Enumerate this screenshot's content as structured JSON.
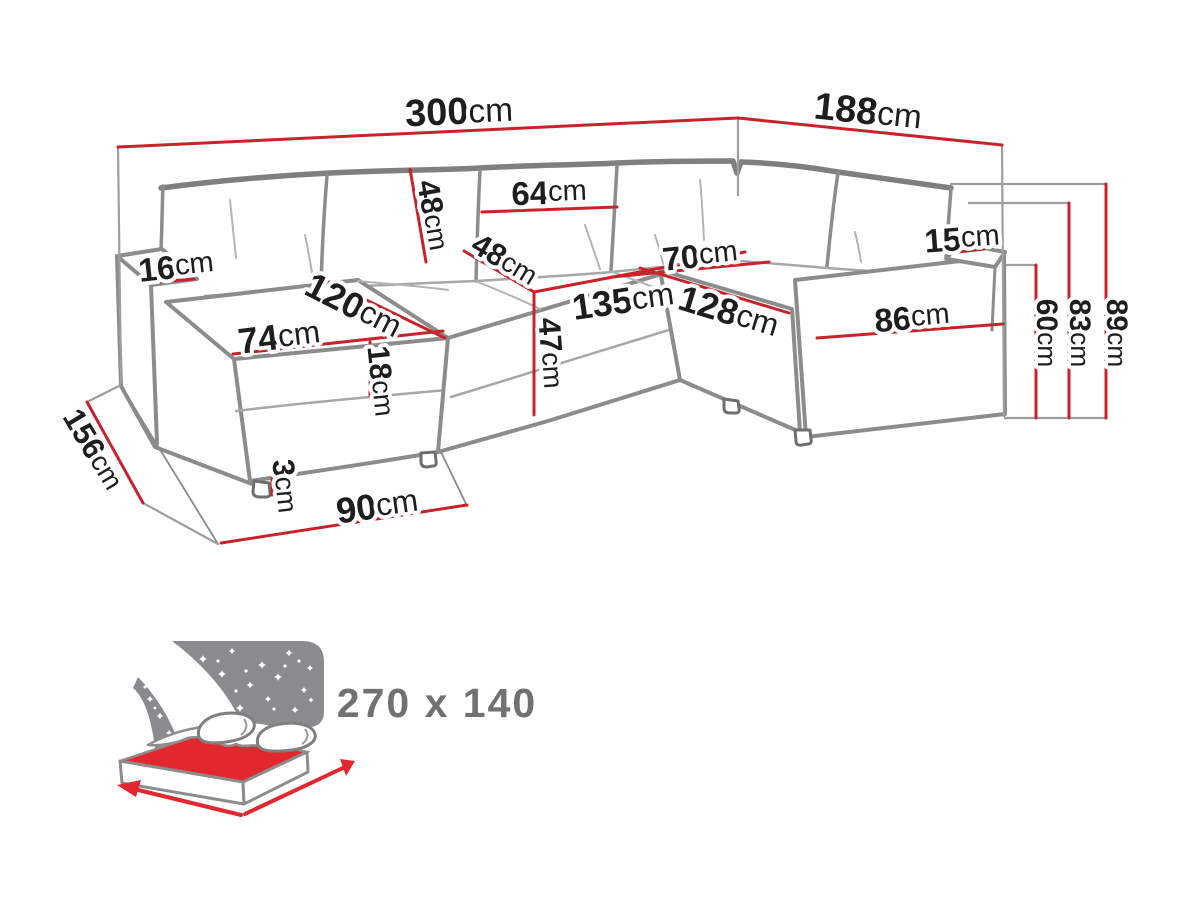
{
  "diagram": {
    "type": "furniture-dimension-diagram",
    "subject": "U-shaped corner sofa with sleeping function",
    "unit": "cm",
    "colors": {
      "background": "#ffffff",
      "dimension_red": "#c8232a",
      "sofa_outline_gray": "#8c8c8c",
      "projection_gray": "#9e9e9e",
      "label_black": "#1e1e1e",
      "icon_sky_gray": "#898b8e",
      "bed_red": "#e2282e",
      "icon_text_gray": "#717171"
    },
    "dims": {
      "total_width": {
        "value": "300",
        "unit": "cm"
      },
      "total_depth_right": {
        "value": "188",
        "unit": "cm"
      },
      "left_armrest_width": {
        "value": "16",
        "unit": "cm"
      },
      "backrest_cushion_height": {
        "value": "48",
        "unit": "cm"
      },
      "back_cushion_width": {
        "value": "64",
        "unit": "cm"
      },
      "seat_depth": {
        "value": "48",
        "unit": "cm"
      },
      "right_seat_width": {
        "value": "70",
        "unit": "cm"
      },
      "right_armrest_width": {
        "value": "15",
        "unit": "cm"
      },
      "chaise_length": {
        "value": "120",
        "unit": "cm"
      },
      "chaise_width": {
        "value": "74",
        "unit": "cm"
      },
      "seat_cushion_thickness": {
        "value": "18",
        "unit": "cm"
      },
      "middle_seat_width": {
        "value": "135",
        "unit": "cm"
      },
      "right_section_length": {
        "value": "128",
        "unit": "cm"
      },
      "right_armrest_length": {
        "value": "86",
        "unit": "cm"
      },
      "seat_height": {
        "value": "47",
        "unit": "cm"
      },
      "leg_height": {
        "value": "3",
        "unit": "cm"
      },
      "chaise_floor_depth": {
        "value": "90",
        "unit": "cm"
      },
      "total_depth_left": {
        "value": "156",
        "unit": "cm"
      },
      "height_to_armrest": {
        "value": "60",
        "unit": "cm"
      },
      "height_to_backrest": {
        "value": "83",
        "unit": "cm"
      },
      "total_height": {
        "value": "89",
        "unit": "cm"
      }
    },
    "sleeping_area": {
      "label": "270 x 140"
    }
  }
}
